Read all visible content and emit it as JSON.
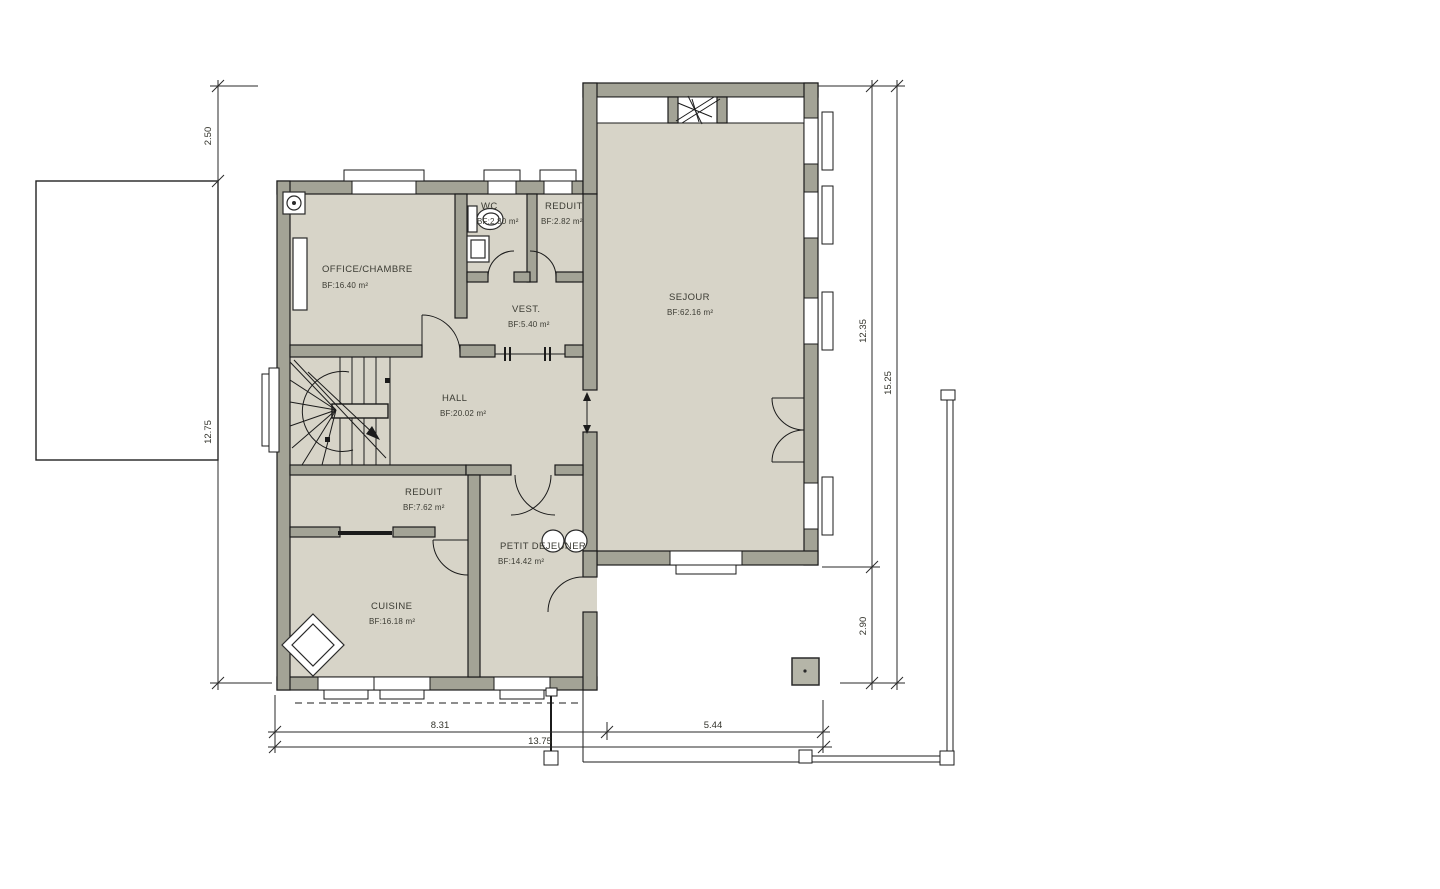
{
  "plan": {
    "title": "floor-plan",
    "rooms": [
      {
        "name": "OFFICE/CHAMBRE",
        "area": "BF:16.40 m²"
      },
      {
        "name": "WC",
        "area": "BF:2.80 m²"
      },
      {
        "name": "REDUIT",
        "area": "BF:2.82 m²"
      },
      {
        "name": "VEST.",
        "area": "BF:5.40 m²"
      },
      {
        "name": "SEJOUR",
        "area": "BF:62.16 m²"
      },
      {
        "name": "HALL",
        "area": "BF:20.02 m²"
      },
      {
        "name": "REDUIT",
        "area": "BF:7.62 m²"
      },
      {
        "name": "PETIT DEJEUNER",
        "area": "BF:14.42 m²"
      },
      {
        "name": "CUISINE",
        "area": "BF:16.18 m²"
      }
    ],
    "dimensions": {
      "left_top": "2.50",
      "left_main": "12.75",
      "right_inner_top": "12.35",
      "right_inner_bottom": "2.90",
      "right_outer": "15.25",
      "bottom_left": "8.31",
      "bottom_right": "5.44",
      "bottom_total": "13.75"
    },
    "colors": {
      "room_fill": "#d7d4c8",
      "wall_fill": "#a3a396",
      "window_fill": "#ffffff",
      "line": "#1b1b1b",
      "text": "#3b3b33"
    }
  }
}
